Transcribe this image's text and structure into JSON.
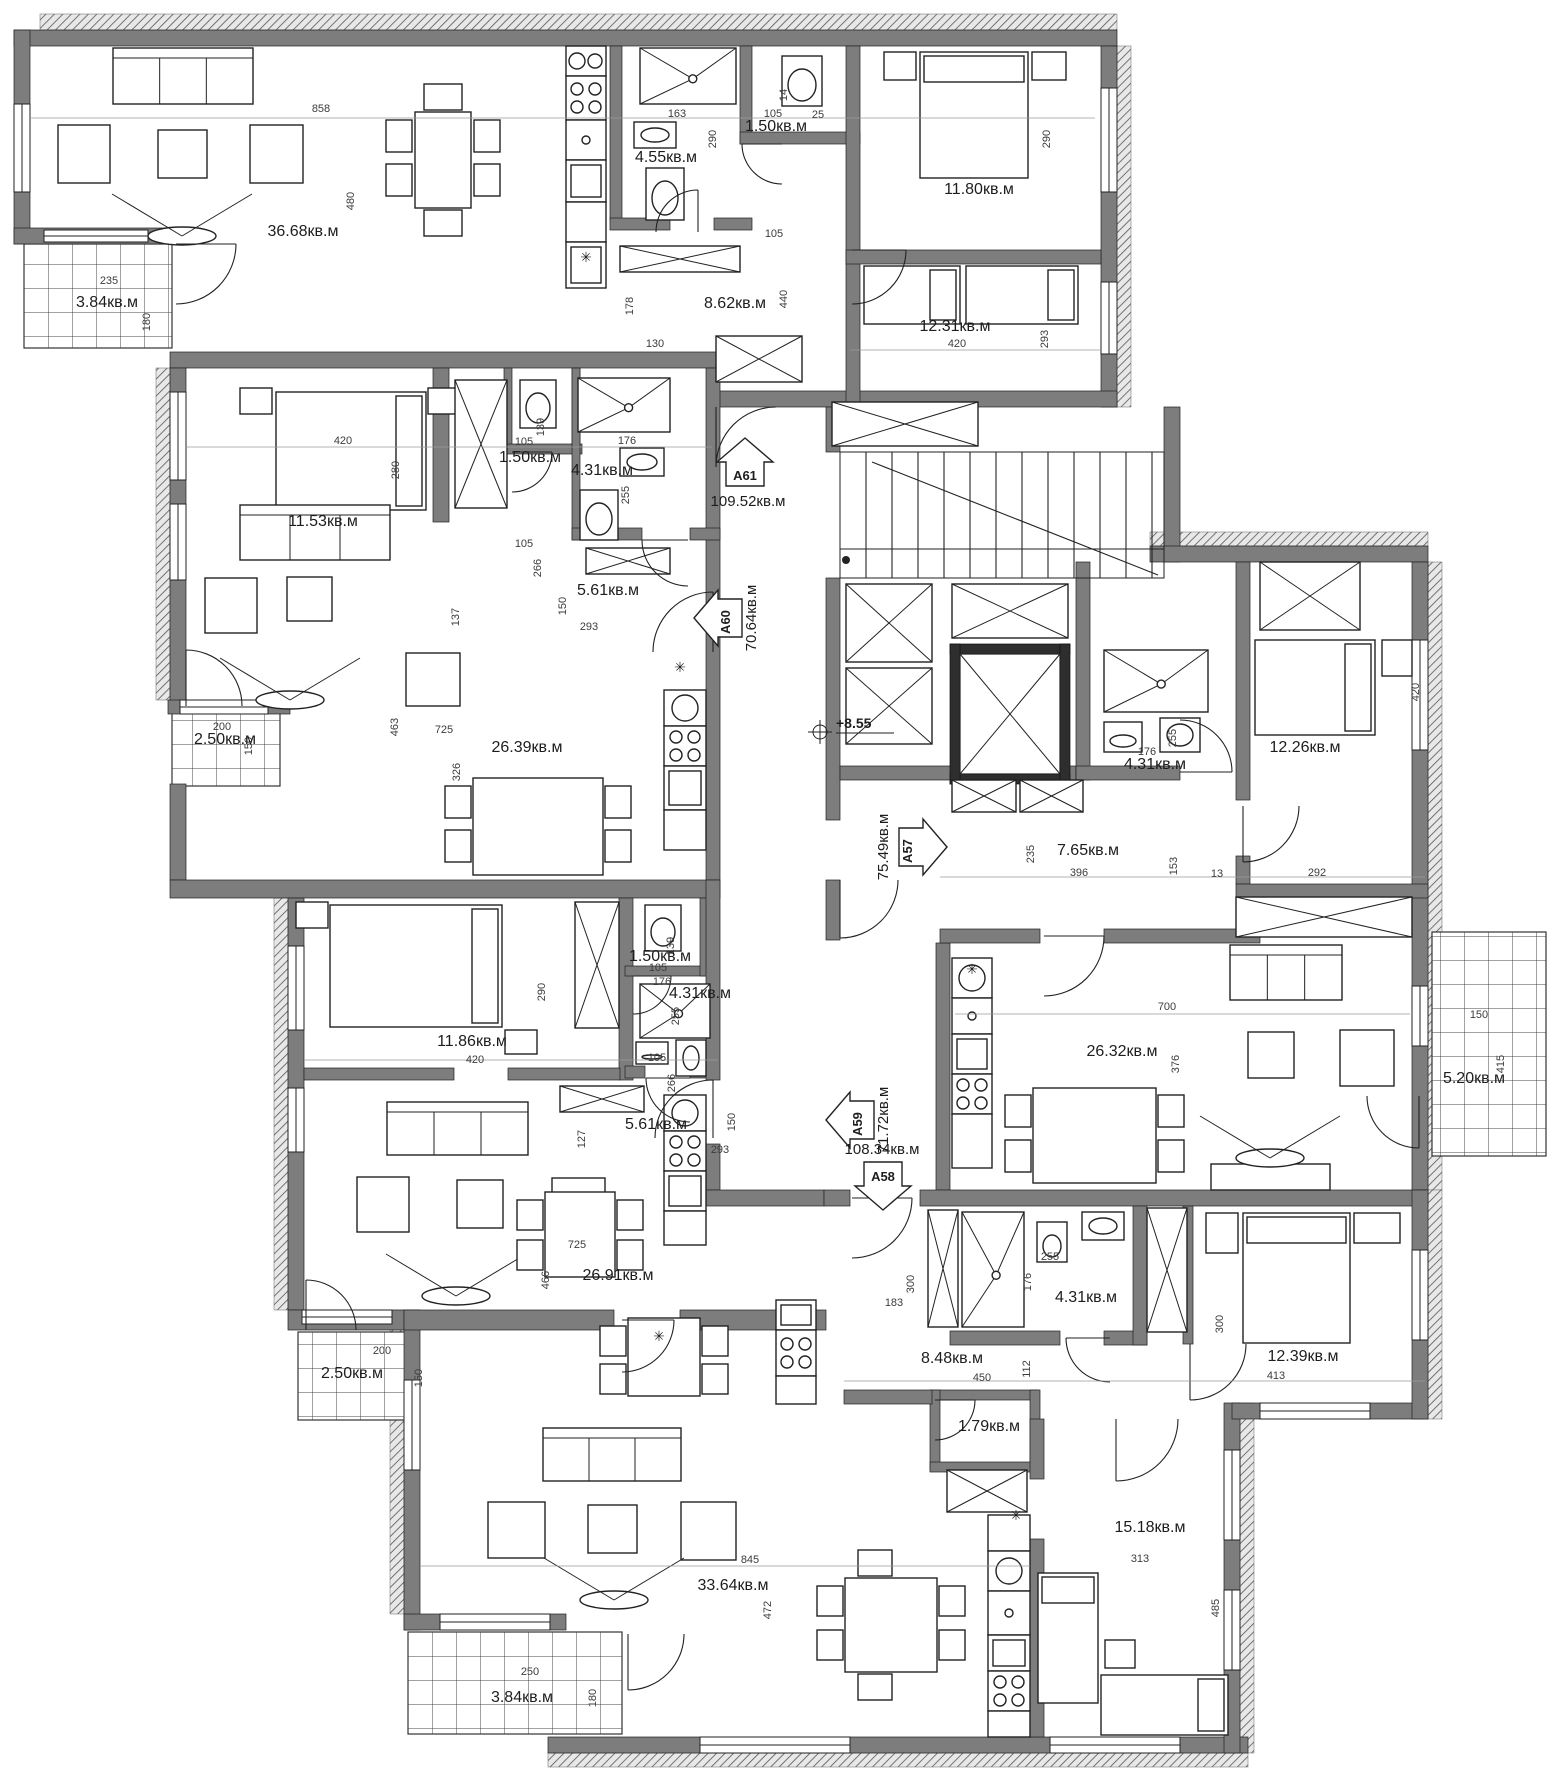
{
  "drawing": {
    "type": "apartment-building-floor-plan",
    "area_unit": "кв.м",
    "level_mark": "+8.55"
  },
  "apartments": [
    {
      "id": "A61",
      "area": "109.52кв.м",
      "entry_direction": "up"
    },
    {
      "id": "A60",
      "area": "70.64кв.м",
      "entry_direction": "left"
    },
    {
      "id": "A57",
      "area": "75.49кв.м",
      "entry_direction": "right"
    },
    {
      "id": "A59",
      "area": "71.72кв.м",
      "entry_direction": "left"
    },
    {
      "id": "A58",
      "area": "108.34кв.м",
      "entry_direction": "down"
    }
  ],
  "room_labels": [
    {
      "t": "36.68кв.м",
      "x": 303,
      "y": 236
    },
    {
      "t": "3.84кв.м",
      "x": 107,
      "y": 307
    },
    {
      "t": "4.55кв.м",
      "x": 666,
      "y": 162
    },
    {
      "t": "1.50кв.м",
      "x": 776,
      "y": 131
    },
    {
      "t": "8.62кв.м",
      "x": 735,
      "y": 308
    },
    {
      "t": "11.80кв.м",
      "x": 979,
      "y": 194
    },
    {
      "t": "12.31кв.м",
      "x": 955,
      "y": 331
    },
    {
      "t": "11.53кв.м",
      "x": 323,
      "y": 526
    },
    {
      "t": "1.50кв.м",
      "x": 530,
      "y": 462
    },
    {
      "t": "4.31кв.м",
      "x": 602,
      "y": 475
    },
    {
      "t": "5.61кв.м",
      "x": 608,
      "y": 595
    },
    {
      "t": "26.39кв.м",
      "x": 527,
      "y": 752
    },
    {
      "t": "2.50кв.м",
      "x": 225,
      "y": 744
    },
    {
      "t": "12.26кв.м",
      "x": 1305,
      "y": 752
    },
    {
      "t": "4.31кв.м",
      "x": 1155,
      "y": 769
    },
    {
      "t": "7.65кв.м",
      "x": 1088,
      "y": 855
    },
    {
      "t": "26.32кв.м",
      "x": 1122,
      "y": 1056
    },
    {
      "t": "5.20кв.м",
      "x": 1474,
      "y": 1083
    },
    {
      "t": "11.86кв.м",
      "x": 472,
      "y": 1046
    },
    {
      "t": "1.50кв.м",
      "x": 660,
      "y": 961
    },
    {
      "t": "4.31кв.м",
      "x": 700,
      "y": 998
    },
    {
      "t": "5.61кв.м",
      "x": 656,
      "y": 1129
    },
    {
      "t": "26.91кв.м",
      "x": 618,
      "y": 1280
    },
    {
      "t": "2.50кв.м",
      "x": 352,
      "y": 1378
    },
    {
      "t": "8.48кв.м",
      "x": 952,
      "y": 1363
    },
    {
      "t": "4.31кв.м",
      "x": 1086,
      "y": 1302
    },
    {
      "t": "12.39кв.м",
      "x": 1303,
      "y": 1361
    },
    {
      "t": "1.79кв.м",
      "x": 989,
      "y": 1431
    },
    {
      "t": "15.18кв.м",
      "x": 1150,
      "y": 1532
    },
    {
      "t": "33.64кв.м",
      "x": 733,
      "y": 1590
    },
    {
      "t": "3.84кв.м",
      "x": 522,
      "y": 1702
    }
  ],
  "dim_labels": [
    {
      "t": "858",
      "x": 321,
      "y": 112
    },
    {
      "t": "480",
      "x": 354,
      "y": 201,
      "r": -90
    },
    {
      "t": "235",
      "x": 109,
      "y": 284
    },
    {
      "t": "180",
      "x": 150,
      "y": 322,
      "r": -90
    },
    {
      "t": "163",
      "x": 677,
      "y": 117
    },
    {
      "t": "105",
      "x": 773,
      "y": 117
    },
    {
      "t": "25",
      "x": 818,
      "y": 118
    },
    {
      "t": "14",
      "x": 787,
      "y": 95,
      "r": -90
    },
    {
      "t": "290",
      "x": 716,
      "y": 139,
      "r": -90
    },
    {
      "t": "105",
      "x": 774,
      "y": 237
    },
    {
      "t": "440",
      "x": 787,
      "y": 299,
      "r": -90
    },
    {
      "t": "178",
      "x": 633,
      "y": 306,
      "r": -90
    },
    {
      "t": "130",
      "x": 655,
      "y": 347
    },
    {
      "t": "290",
      "x": 1050,
      "y": 139,
      "r": -90
    },
    {
      "t": "420",
      "x": 957,
      "y": 347
    },
    {
      "t": "293",
      "x": 1048,
      "y": 339,
      "r": -90
    },
    {
      "t": "420",
      "x": 343,
      "y": 444
    },
    {
      "t": "280",
      "x": 399,
      "y": 470,
      "r": -90
    },
    {
      "t": "105",
      "x": 524,
      "y": 445
    },
    {
      "t": "139",
      "x": 544,
      "y": 427,
      "r": -90
    },
    {
      "t": "176",
      "x": 627,
      "y": 444
    },
    {
      "t": "255",
      "x": 629,
      "y": 495,
      "r": -90
    },
    {
      "t": "105",
      "x": 524,
      "y": 547
    },
    {
      "t": "266",
      "x": 541,
      "y": 568,
      "r": -90
    },
    {
      "t": "150",
      "x": 566,
      "y": 606,
      "r": -90
    },
    {
      "t": "293",
      "x": 589,
      "y": 630
    },
    {
      "t": "137",
      "x": 459,
      "y": 617,
      "r": -90
    },
    {
      "t": "463",
      "x": 398,
      "y": 727,
      "r": -90
    },
    {
      "t": "725",
      "x": 444,
      "y": 733
    },
    {
      "t": "326",
      "x": 460,
      "y": 772,
      "r": -90
    },
    {
      "t": "200",
      "x": 222,
      "y": 730
    },
    {
      "t": "150",
      "x": 252,
      "y": 746,
      "r": -90
    },
    {
      "t": "235",
      "x": 1034,
      "y": 854,
      "r": -90
    },
    {
      "t": "396",
      "x": 1079,
      "y": 876
    },
    {
      "t": "153",
      "x": 1177,
      "y": 866,
      "r": -90
    },
    {
      "t": "13",
      "x": 1217,
      "y": 877
    },
    {
      "t": "292",
      "x": 1317,
      "y": 876
    },
    {
      "t": "176",
      "x": 1147,
      "y": 755
    },
    {
      "t": "255",
      "x": 1176,
      "y": 738,
      "r": -90
    },
    {
      "t": "700",
      "x": 1167,
      "y": 1010
    },
    {
      "t": "376",
      "x": 1179,
      "y": 1064,
      "r": -90
    },
    {
      "t": "150",
      "x": 1479,
      "y": 1018
    },
    {
      "t": "415",
      "x": 1504,
      "y": 1064,
      "r": -90
    },
    {
      "t": "420",
      "x": 1419,
      "y": 692,
      "r": -90
    },
    {
      "t": "420",
      "x": 475,
      "y": 1063
    },
    {
      "t": "290",
      "x": 545,
      "y": 992,
      "r": -90
    },
    {
      "t": "105",
      "x": 658,
      "y": 971
    },
    {
      "t": "139",
      "x": 674,
      "y": 946,
      "r": -90
    },
    {
      "t": "176",
      "x": 662,
      "y": 985
    },
    {
      "t": "255",
      "x": 679,
      "y": 1016,
      "r": -90
    },
    {
      "t": "105",
      "x": 657,
      "y": 1061
    },
    {
      "t": "266",
      "x": 675,
      "y": 1083,
      "r": -90
    },
    {
      "t": "150",
      "x": 735,
      "y": 1122,
      "r": -90
    },
    {
      "t": "293",
      "x": 720,
      "y": 1153
    },
    {
      "t": "127",
      "x": 585,
      "y": 1139,
      "r": -90
    },
    {
      "t": "725",
      "x": 577,
      "y": 1248
    },
    {
      "t": "466",
      "x": 549,
      "y": 1280,
      "r": -90
    },
    {
      "t": "200",
      "x": 382,
      "y": 1354
    },
    {
      "t": "150",
      "x": 422,
      "y": 1378,
      "r": -90
    },
    {
      "t": "255",
      "x": 1050,
      "y": 1260
    },
    {
      "t": "176",
      "x": 1031,
      "y": 1282,
      "r": -90
    },
    {
      "t": "300",
      "x": 914,
      "y": 1284,
      "r": -90
    },
    {
      "t": "183",
      "x": 894,
      "y": 1306
    },
    {
      "t": "450",
      "x": 982,
      "y": 1381
    },
    {
      "t": "112",
      "x": 1030,
      "y": 1369,
      "r": -90
    },
    {
      "t": "300",
      "x": 1223,
      "y": 1324,
      "r": -90
    },
    {
      "t": "413",
      "x": 1276,
      "y": 1379
    },
    {
      "t": "313",
      "x": 1140,
      "y": 1562
    },
    {
      "t": "485",
      "x": 1219,
      "y": 1608,
      "r": -90
    },
    {
      "t": "845",
      "x": 750,
      "y": 1563
    },
    {
      "t": "472",
      "x": 771,
      "y": 1610,
      "r": -90
    },
    {
      "t": "250",
      "x": 530,
      "y": 1675
    },
    {
      "t": "180",
      "x": 596,
      "y": 1698,
      "r": -90
    }
  ],
  "symbols": [
    {
      "t": "✳",
      "x": 586,
      "y": 262
    },
    {
      "t": "✳",
      "x": 680,
      "y": 672
    },
    {
      "t": "✳",
      "x": 972,
      "y": 974
    },
    {
      "t": "✳",
      "x": 1016,
      "y": 1520
    },
    {
      "t": "✳",
      "x": 659,
      "y": 1341
    }
  ]
}
